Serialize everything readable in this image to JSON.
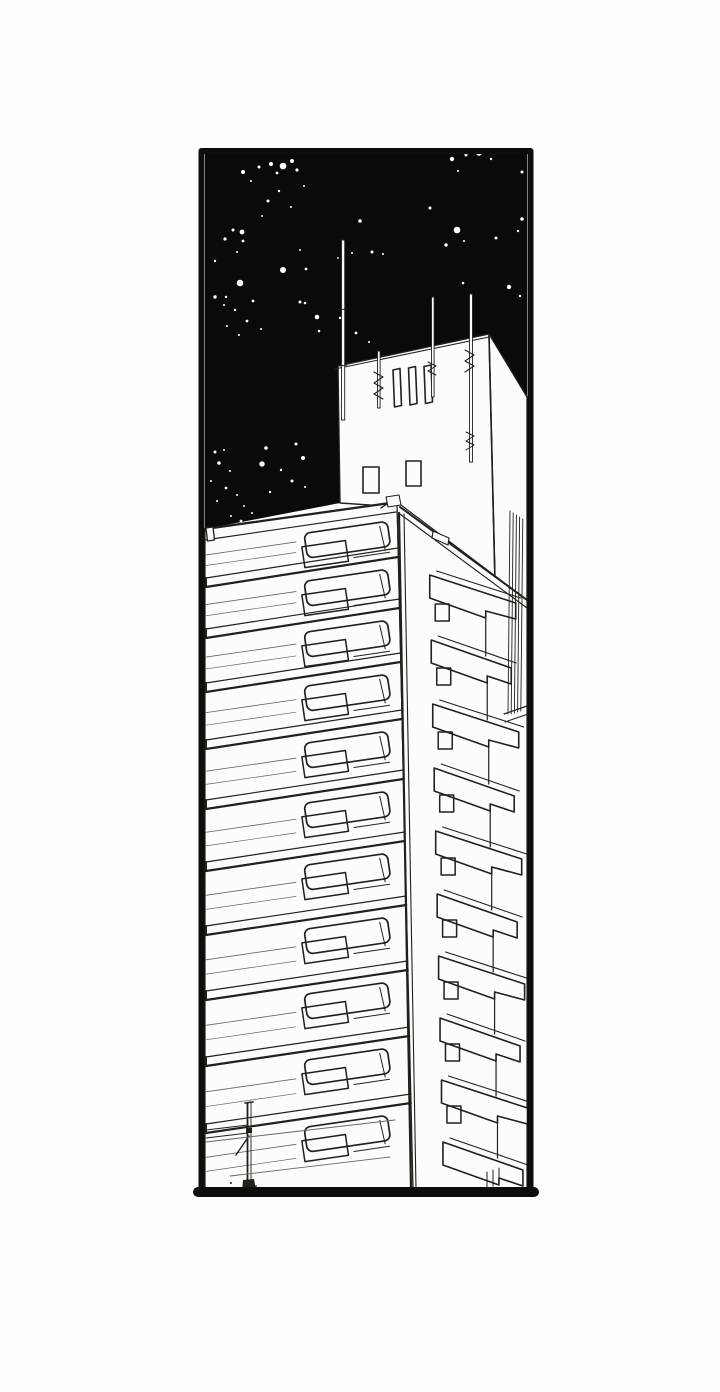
{
  "scene": {
    "kind": "manga-panel-illustration",
    "subject": "low-angle night view of a tall apartment tower with rooftop antennas against a starry black sky",
    "panel": {
      "x": 201,
      "y": 151,
      "width": 329,
      "height": 1042
    },
    "palette": {
      "paper": "#fcfcfa",
      "ink": "#232019",
      "ink_soft": "#6b655e",
      "sky": "#0a0a09",
      "star": "#ffffff",
      "border": "#0d0d0c",
      "page": "#fdfdfd"
    }
  },
  "stars": [
    [
      243,
      172,
      2
    ],
    [
      259,
      167,
      1.5
    ],
    [
      251,
      181,
      1
    ],
    [
      283,
      166,
      3.3
    ],
    [
      292,
      161,
      2
    ],
    [
      271,
      164,
      2
    ],
    [
      277,
      173,
      1.4
    ],
    [
      297,
      170,
      1.6
    ],
    [
      279,
      191,
      1.2
    ],
    [
      268,
      201,
      1.5
    ],
    [
      291,
      207,
      1
    ],
    [
      262,
      216,
      1
    ],
    [
      304,
      186,
      1
    ],
    [
      360,
      221,
      1.8
    ],
    [
      430,
      208,
      1.5
    ],
    [
      372,
      252,
      1.5
    ],
    [
      383,
      254,
      1
    ],
    [
      338,
      258,
      0.9
    ],
    [
      352,
      253,
      1
    ],
    [
      340,
      318,
      1.2
    ],
    [
      233,
      230,
      1.5
    ],
    [
      242,
      232,
      2.4
    ],
    [
      243,
      241,
      1.4
    ],
    [
      225,
      239,
      1.6
    ],
    [
      215,
      261,
      1.2
    ],
    [
      237,
      252,
      1
    ],
    [
      283,
      270,
      3
    ],
    [
      306,
      269,
      1.4
    ],
    [
      300,
      250,
      1
    ],
    [
      240,
      283,
      3.3
    ],
    [
      215,
      297,
      1.7
    ],
    [
      226,
      297,
      1.2
    ],
    [
      224,
      305,
      1
    ],
    [
      235,
      310,
      1.2
    ],
    [
      253,
      301,
      1.4
    ],
    [
      247,
      321,
      1.4
    ],
    [
      261,
      329,
      1
    ],
    [
      239,
      335,
      1
    ],
    [
      227,
      326,
      1
    ],
    [
      300,
      302,
      1.5
    ],
    [
      305,
      303,
      1.3
    ],
    [
      317,
      317,
      2.3
    ],
    [
      319,
      331,
      1.3
    ],
    [
      343,
      329,
      1
    ],
    [
      356,
      333,
      1.4
    ],
    [
      369,
      342,
      1
    ],
    [
      452,
      159,
      2.2
    ],
    [
      466,
      155,
      1.5
    ],
    [
      479,
      153,
      2.8
    ],
    [
      491,
      159,
      1.2
    ],
    [
      503,
      151,
      1
    ],
    [
      522,
      172,
      1.5
    ],
    [
      458,
      171,
      1
    ],
    [
      457,
      230,
      3.3
    ],
    [
      446,
      245,
      1.7
    ],
    [
      496,
      238,
      1.5
    ],
    [
      522,
      219,
      1.8
    ],
    [
      518,
      231,
      1.2
    ],
    [
      464,
      241,
      1
    ],
    [
      509,
      287,
      2.2
    ],
    [
      520,
      296,
      1.2
    ],
    [
      463,
      283,
      1.3
    ],
    [
      215,
      452,
      1.5
    ],
    [
      262,
      464,
      2.7
    ],
    [
      266,
      448,
      1.8
    ],
    [
      296,
      444,
      1.5
    ],
    [
      303,
      458,
      2
    ],
    [
      281,
      470,
      1.2
    ],
    [
      292,
      481,
      1.5
    ],
    [
      270,
      492,
      1.2
    ],
    [
      305,
      487,
      1
    ],
    [
      224,
      450,
      1
    ],
    [
      219,
      463,
      1.8
    ],
    [
      230,
      471,
      1
    ],
    [
      211,
      481,
      1
    ],
    [
      226,
      488,
      1.4
    ],
    [
      237,
      495,
      1
    ],
    [
      217,
      501,
      1
    ],
    [
      244,
      506,
      1
    ],
    [
      252,
      513,
      1
    ],
    [
      231,
      516,
      1
    ],
    [
      241,
      521,
      1.4
    ],
    [
      254,
      526,
      1
    ]
  ],
  "building": {
    "corner_top": {
      "x": 397,
      "y": 501
    },
    "corner_slope": 0.0233,
    "left_face_floor_boundaries": [
      530,
      578,
      629,
      683,
      740,
      800,
      862,
      926,
      991,
      1057,
      1124,
      1188
    ],
    "right_face_balcony_tops": [
      575,
      640,
      704,
      768,
      831,
      894,
      956,
      1018,
      1080,
      1142
    ]
  }
}
